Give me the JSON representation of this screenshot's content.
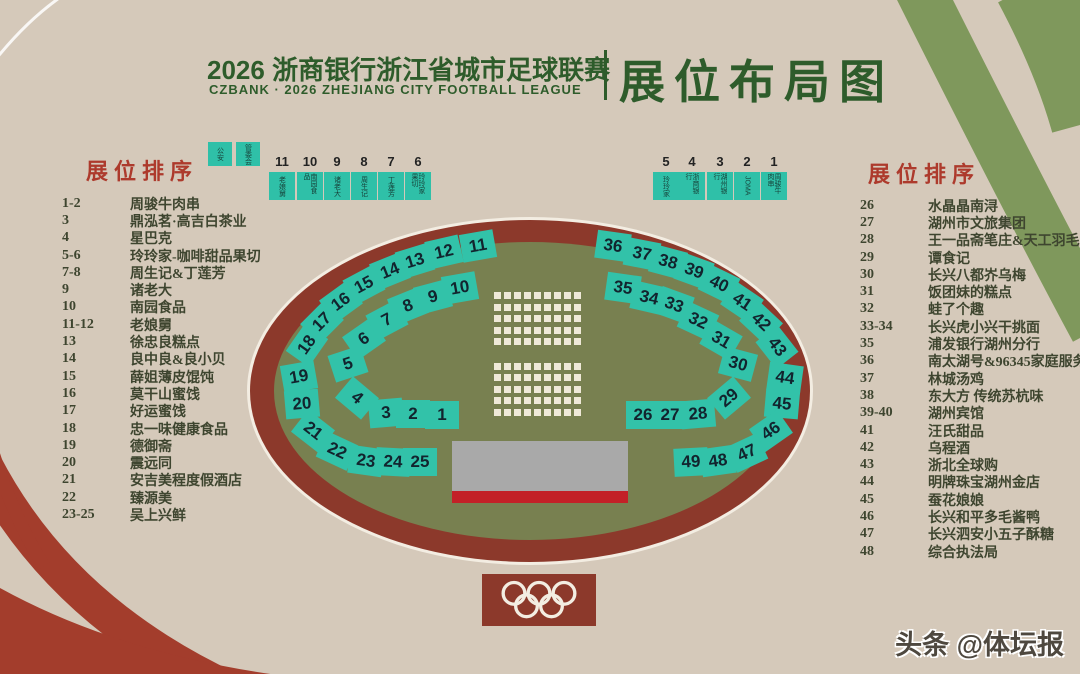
{
  "header": {
    "title_cn": "2026 浙商银行浙江省城市足球联赛",
    "title_en": "CZBANK · 2026 ZHEJIANG CITY FOOTBALL LEAGUE",
    "title_right": "展位布局图"
  },
  "left_panel": {
    "heading": "展位排序",
    "items": [
      {
        "no": "1-2",
        "name": "周骏牛肉串"
      },
      {
        "no": "3",
        "name": "鼎泓茗·高吉白茶业"
      },
      {
        "no": "4",
        "name": "星巴克"
      },
      {
        "no": "5-6",
        "name": "玲玲家-咖啡甜品果切"
      },
      {
        "no": "7-8",
        "name": "周生记&丁莲芳"
      },
      {
        "no": "9",
        "name": "诸老大"
      },
      {
        "no": "10",
        "name": "南园食品"
      },
      {
        "no": "11-12",
        "name": "老娘舅"
      },
      {
        "no": "13",
        "name": "徐忠良糕点"
      },
      {
        "no": "14",
        "name": "良中良&良小贝"
      },
      {
        "no": "15",
        "name": "薛姐薄皮馄饨"
      },
      {
        "no": "16",
        "name": "莫干山蜜饯"
      },
      {
        "no": "17",
        "name": "好运蜜饯"
      },
      {
        "no": "18",
        "name": "忠一味健康食品"
      },
      {
        "no": "19",
        "name": "德御斋"
      },
      {
        "no": "20",
        "name": "震远同"
      },
      {
        "no": "21",
        "name": "安吉美程度假酒店"
      },
      {
        "no": "22",
        "name": "臻源美"
      },
      {
        "no": "23-25",
        "name": "吴上兴鲜"
      }
    ]
  },
  "right_panel": {
    "heading": "展位排序",
    "items": [
      {
        "no": "26",
        "name": "水晶晶南浔"
      },
      {
        "no": "27",
        "name": "湖州市文旅集团"
      },
      {
        "no": "28",
        "name": "王一品斋笔庄&天工羽毛扇"
      },
      {
        "no": "29",
        "name": "谭食记"
      },
      {
        "no": "30",
        "name": "长兴八都岕乌梅"
      },
      {
        "no": "31",
        "name": "饭团妹的糕点"
      },
      {
        "no": "32",
        "name": "蛙了个趣"
      },
      {
        "no": "33-34",
        "name": "长兴虎小兴干挑面"
      },
      {
        "no": "35",
        "name": "浦发银行湖州分行"
      },
      {
        "no": "36",
        "name": "南太湖号&96345家庭服务"
      },
      {
        "no": "37",
        "name": "林城汤鸡"
      },
      {
        "no": "38",
        "name": "东大方 传统苏杭味"
      },
      {
        "no": "39-40",
        "name": "湖州宾馆"
      },
      {
        "no": "41",
        "name": "汪氏甜品"
      },
      {
        "no": "42",
        "name": "乌程酒"
      },
      {
        "no": "43",
        "name": "浙北全球购"
      },
      {
        "no": "44",
        "name": "明牌珠宝湖州金店"
      },
      {
        "no": "45",
        "name": "蚕花娘娘"
      },
      {
        "no": "46",
        "name": "长兴和平多毛酱鸭"
      },
      {
        "no": "47",
        "name": "长兴泗安小五子酥糖"
      },
      {
        "no": "48",
        "name": "综合执法局"
      }
    ]
  },
  "top_strip": {
    "service_booths": [
      {
        "label": "公安",
        "x": 220
      },
      {
        "label": "管委会",
        "x": 248
      }
    ],
    "left_row": [
      {
        "no": "11",
        "label": "老娘舅",
        "x": 282
      },
      {
        "no": "10",
        "label": "南园食品",
        "x": 310
      },
      {
        "no": "9",
        "label": "诸老大",
        "x": 337
      },
      {
        "no": "8",
        "label": "周生记",
        "x": 364
      },
      {
        "no": "7",
        "label": "丁莲芳",
        "x": 391
      },
      {
        "no": "6",
        "label": "玲玲家果切",
        "x": 418
      }
    ],
    "right_row": [
      {
        "no": "5",
        "label": "玲玲家",
        "x": 666
      },
      {
        "no": "4",
        "label": "浙商银行",
        "x": 692
      },
      {
        "no": "3",
        "label": "湖州银行",
        "x": 720
      },
      {
        "no": "2",
        "label": "JOMA",
        "x": 747
      },
      {
        "no": "1",
        "label": "周骏牛肉串",
        "x": 774
      }
    ]
  },
  "stadium": {
    "booths": [
      {
        "no": "1",
        "x": 442,
        "y": 415,
        "r": 0
      },
      {
        "no": "2",
        "x": 413,
        "y": 414,
        "r": 0
      },
      {
        "no": "3",
        "x": 386,
        "y": 413,
        "r": -5
      },
      {
        "no": "4",
        "x": 357,
        "y": 398,
        "r": 40
      },
      {
        "no": "5",
        "x": 348,
        "y": 364,
        "r": -18
      },
      {
        "no": "6",
        "x": 364,
        "y": 339,
        "r": -35
      },
      {
        "no": "7",
        "x": 387,
        "y": 320,
        "r": -28
      },
      {
        "no": "8",
        "x": 408,
        "y": 306,
        "r": -22
      },
      {
        "no": "9",
        "x": 433,
        "y": 297,
        "r": -15
      },
      {
        "no": "10",
        "x": 460,
        "y": 288,
        "r": -10
      },
      {
        "no": "11",
        "x": 478,
        "y": 246,
        "r": -10
      },
      {
        "no": "12",
        "x": 444,
        "y": 252,
        "r": -13
      },
      {
        "no": "13",
        "x": 415,
        "y": 261,
        "r": -17
      },
      {
        "no": "14",
        "x": 390,
        "y": 271,
        "r": -22
      },
      {
        "no": "15",
        "x": 364,
        "y": 285,
        "r": -28
      },
      {
        "no": "16",
        "x": 341,
        "y": 302,
        "r": -36
      },
      {
        "no": "17",
        "x": 322,
        "y": 322,
        "r": -45
      },
      {
        "no": "18",
        "x": 307,
        "y": 345,
        "r": -55
      },
      {
        "no": "19",
        "x": 299,
        "y": 377,
        "r": -10
      },
      {
        "no": "20",
        "x": 302,
        "y": 404,
        "r": -5
      },
      {
        "no": "21",
        "x": 313,
        "y": 431,
        "r": 38
      },
      {
        "no": "22",
        "x": 337,
        "y": 451,
        "r": 25
      },
      {
        "no": "23",
        "x": 366,
        "y": 461,
        "r": 8
      },
      {
        "no": "24",
        "x": 393,
        "y": 462,
        "r": 3
      },
      {
        "no": "25",
        "x": 420,
        "y": 462,
        "r": 0
      },
      {
        "no": "26",
        "x": 643,
        "y": 415,
        "r": 0
      },
      {
        "no": "27",
        "x": 670,
        "y": 415,
        "r": 0
      },
      {
        "no": "28",
        "x": 698,
        "y": 414,
        "r": -5
      },
      {
        "no": "29",
        "x": 729,
        "y": 398,
        "r": -40
      },
      {
        "no": "30",
        "x": 738,
        "y": 364,
        "r": 15
      },
      {
        "no": "31",
        "x": 721,
        "y": 340,
        "r": 30
      },
      {
        "no": "32",
        "x": 698,
        "y": 321,
        "r": 25
      },
      {
        "no": "33",
        "x": 674,
        "y": 305,
        "r": 20
      },
      {
        "no": "34",
        "x": 649,
        "y": 298,
        "r": 13
      },
      {
        "no": "35",
        "x": 623,
        "y": 288,
        "r": 8
      },
      {
        "no": "36",
        "x": 613,
        "y": 246,
        "r": 8
      },
      {
        "no": "37",
        "x": 642,
        "y": 254,
        "r": 11
      },
      {
        "no": "38",
        "x": 668,
        "y": 262,
        "r": 15
      },
      {
        "no": "39",
        "x": 694,
        "y": 271,
        "r": 20
      },
      {
        "no": "40",
        "x": 719,
        "y": 284,
        "r": 26
      },
      {
        "no": "41",
        "x": 742,
        "y": 302,
        "r": 34
      },
      {
        "no": "42",
        "x": 761,
        "y": 322,
        "r": 43
      },
      {
        "no": "43",
        "x": 777,
        "y": 347,
        "r": 52
      },
      {
        "no": "44",
        "x": 785,
        "y": 378,
        "r": 8
      },
      {
        "no": "45",
        "x": 782,
        "y": 404,
        "r": 5
      },
      {
        "no": "46",
        "x": 771,
        "y": 431,
        "r": -35
      },
      {
        "no": "47",
        "x": 747,
        "y": 453,
        "r": -25
      },
      {
        "no": "48",
        "x": 718,
        "y": 461,
        "r": -8
      },
      {
        "no": "49",
        "x": 691,
        "y": 462,
        "r": -3
      }
    ],
    "audience_grid": {
      "cols": 9,
      "row_groups": [
        5,
        5
      ],
      "cell": 7,
      "pitch_x": 10,
      "pitch_y": 11.5,
      "group_gap": 13,
      "x": 494,
      "y": 292
    }
  },
  "footer": {
    "watermark": "头条 @体坛报"
  },
  "colors": {
    "background": "#d5c9ba",
    "title_green": "#2e5c2b",
    "heading_red": "#ad3a2c",
    "list_text": "#3e452f",
    "booth_teal": "#32c2a9",
    "track_maroon": "#8c392b",
    "field_olive": "#788050",
    "stage_gray": "#a9a9a9",
    "stage_red": "#c32127",
    "band_green": "#7f985c",
    "band_red": "#a33d2c"
  }
}
